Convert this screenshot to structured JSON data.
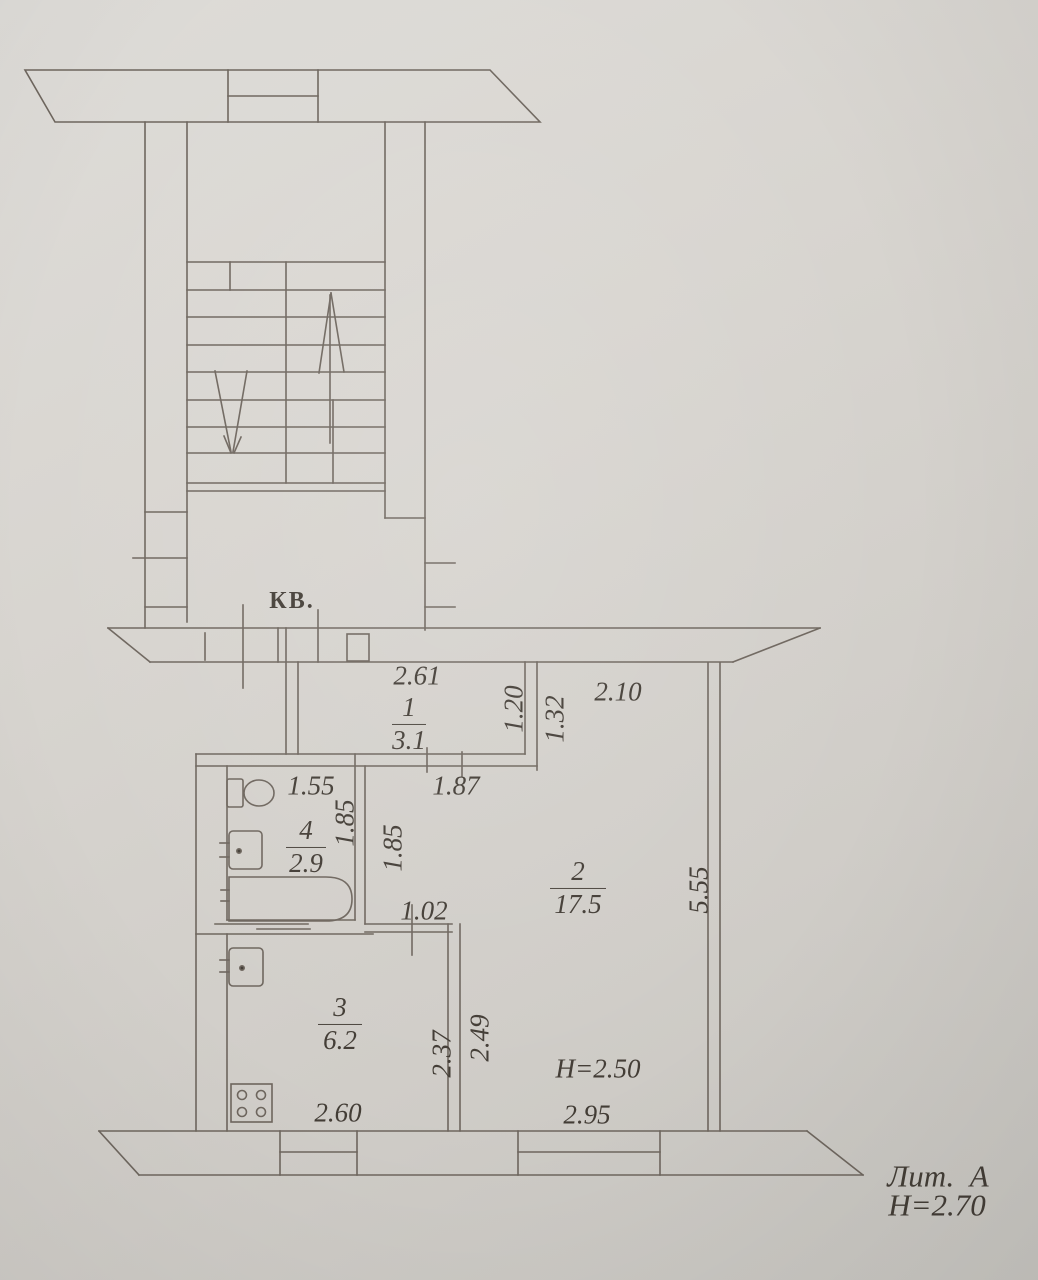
{
  "stairwell": {
    "apartment_marker": "КВ."
  },
  "rooms": [
    {
      "number": "1",
      "area": "3.1"
    },
    {
      "number": "2",
      "area": "17.5"
    },
    {
      "number": "3",
      "area": "6.2"
    },
    {
      "number": "4",
      "area": "2.9"
    }
  ],
  "dims": {
    "hall_top_width": "2.61",
    "hall_height": "1.20",
    "living_upper_height": "1.32",
    "living_top_width": "2.10",
    "bath_top_width": "1.55",
    "corridor_top_width": "1.87",
    "bath_side_depth": "1.85",
    "corridor_side_depth": "1.85",
    "corridor_bottom_width": "1.02",
    "living_side_height": "5.55",
    "kitchen_side_depth": "2.37",
    "living_nook_depth": "2.49",
    "kitchen_bottom_width": "2.60",
    "living_bottom_width": "2.95"
  },
  "notes": {
    "living_ceiling_height": "Н=2.50",
    "litera": "Лит.  А",
    "building_height": "Н=2.70"
  },
  "colors": {
    "paper": "#d6d3ce",
    "ink": "#6e665e",
    "text": "#433d36"
  }
}
